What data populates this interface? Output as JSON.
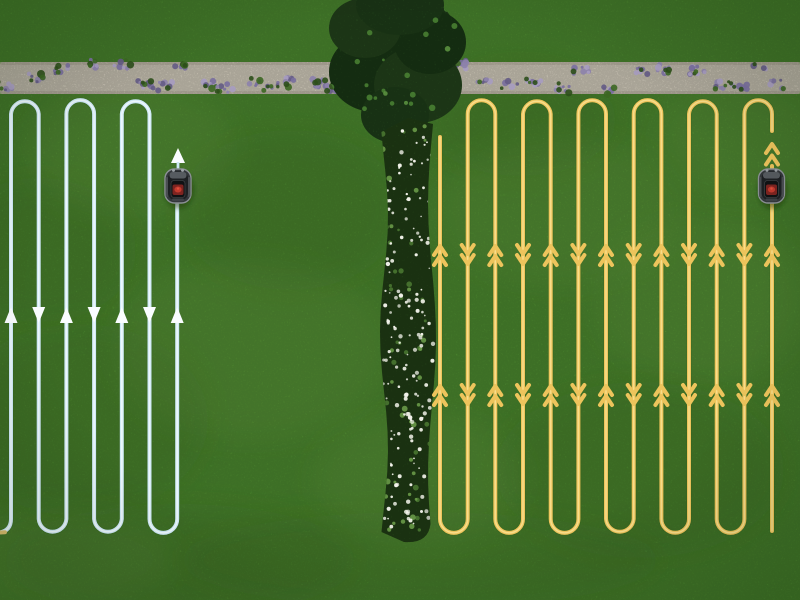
{
  "scene": {
    "description": "Aerial top-down view of a lawn. Two robotic lawn mowers mow parallel serpentine tracks: a light-blue track zone on the left and a denser yellow track zone on the right, separated by a tall hedge and a vertical white-flower bed. A light gravel path bordered with lavender clumps runs along the top.",
    "canvas": {
      "width": 800,
      "height": 600
    },
    "colors": {
      "grass_base": "#5aa238",
      "grass_dark": "#3f7d28",
      "grass_light": "#8cc755",
      "gravel_path": "#eae3d1",
      "gravel_edge": "#c9c2ae",
      "lavender_main": "#8d82ab",
      "lavender_light": "#a79cc0",
      "lavender_dark": "#655c86",
      "foliage_green": "#3c6722",
      "hedge_green": "#2d5a25",
      "hedge_dark": "#1f4419",
      "hedge_light": "#4f8a36",
      "flower_strip_green": "#2c521d",
      "white_flower": "#f4f4ec",
      "blue_track": "#cfe9f6",
      "blue_track_core": "#eef8fd",
      "yellow_track": "#edc45c",
      "yellow_track_core": "#f8dd8a",
      "tan_exit": "#d9bd6e",
      "mower_body": "#33373b",
      "mower_rim": "#8b9095",
      "mower_deck": "#1d2023",
      "mower_front": "#565b60",
      "mower_console": "#101214",
      "mower_red": "#7e2420",
      "mower_red_bright": "#c23a2e",
      "white_arrow": "#fafdff"
    },
    "left_zone": {
      "track_color_name": "light-blue",
      "lines": 7,
      "first_line_x": 11,
      "line_spacing": 27.7,
      "track_top_y": 114,
      "track_bottom_y": 519,
      "top_arc_pairs": [
        [
          0,
          1
        ],
        [
          2,
          3
        ],
        [
          4,
          5
        ]
      ],
      "bottom_arc_pairs": [
        [
          1,
          2
        ],
        [
          3,
          4
        ],
        [
          5,
          6
        ]
      ],
      "exit_bottom_left": true,
      "arrow_row_y": 315,
      "arrow_style": "single-solid-triangle",
      "arrow_dirs": [
        "up",
        "down",
        "up",
        "down",
        "up",
        "down",
        "up"
      ],
      "mower_line_index": 6,
      "below_mower_y": 204,
      "mower": {
        "x": 178,
        "y": 186,
        "heading": "up",
        "arrows_above": 1
      }
    },
    "right_zone": {
      "track_color_name": "yellow",
      "lines": 13,
      "first_line_x": 440,
      "line_spacing": 27.67,
      "track_top_y": 114,
      "track_bottom_y": 519,
      "first_line_top_free_y": 137,
      "top_arc_pairs": [
        [
          1,
          2
        ],
        [
          3,
          4
        ],
        [
          5,
          6
        ],
        [
          7,
          8
        ],
        [
          9,
          10
        ],
        [
          11,
          12
        ]
      ],
      "bottom_arc_pairs": [
        [
          0,
          1
        ],
        [
          2,
          3
        ],
        [
          4,
          5
        ],
        [
          6,
          7
        ],
        [
          8,
          9
        ],
        [
          10,
          11
        ]
      ],
      "arrow_rows_y": [
        250,
        390
      ],
      "arrow_style": "double-chevron",
      "mower_line_index": 12,
      "top_stub_y": 131,
      "below_mower_y": 204,
      "last_line_bottom_y": 531,
      "mower": {
        "x": 771.5,
        "y": 186,
        "heading": "up",
        "arrows_above": 2
      }
    },
    "gravel_path": {
      "y_top": 62,
      "height": 32,
      "left_segment": [
        0,
        348
      ],
      "right_segment": [
        452,
        800
      ]
    },
    "hedge": {
      "center_x": 398,
      "blob_top_y": 0,
      "blob_bottom_y": 140
    },
    "flower_strip": {
      "center_x": 408,
      "half_width": 24,
      "y_top": 124,
      "y_bottom": 532
    }
  }
}
